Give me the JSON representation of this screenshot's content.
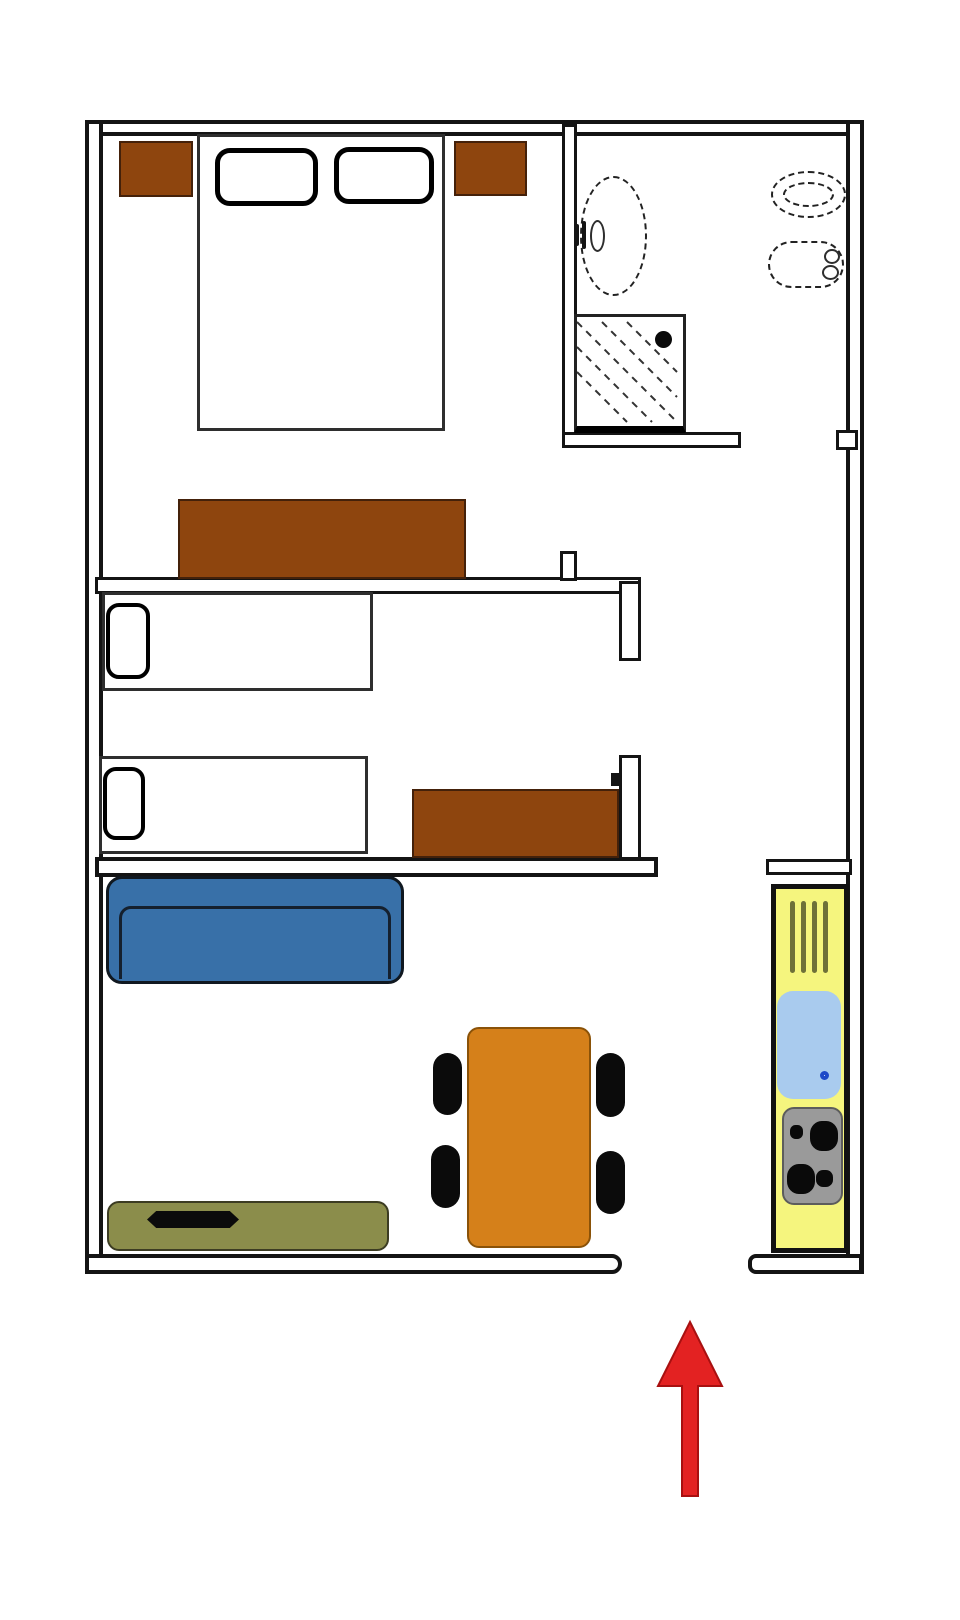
{
  "page": {
    "type": "apartment floor plan diagram",
    "orientation": "entrance at bottom, indicated by red arrow pointing up",
    "visible_text": "none"
  },
  "colors": {
    "background": "#ffffff",
    "wall_outline": "#141414",
    "wall_core": "#ffffff",
    "fixture_line": "#222222",
    "furniture_brown": "#8E450E",
    "bed_white": "#ffffff",
    "sofa_blue": "#3870A8",
    "table_orange": "#D5801A",
    "chair_black": "#0b0b0b",
    "sideboard_olive": "#8B8D4B",
    "tv_black": "#0b0b0b",
    "kitchen_yellow": "#F5F57E",
    "sink_light_blue": "#A9CBEE",
    "drain_blue": "#1d49c8",
    "stove_gray": "#9A9A9A",
    "burner_black": "#0a0a0a",
    "radiator_olive": "#6E7038",
    "arrow_red": "#E32222",
    "arrow_red_dark": "#A81010"
  },
  "rooms": [
    {
      "id": "master-bedroom",
      "position": "top-left",
      "furniture": [
        "double bed with 2 pillows",
        "nightstand left",
        "nightstand right",
        "dresser at foot wall"
      ]
    },
    {
      "id": "bathroom",
      "position": "top-right",
      "fixtures": [
        "washbasin (dashed oval with taps)",
        "toilet (double dashed oval)",
        "bidet (dashed, two holes)",
        "shower tray (hatched, drain dot)"
      ]
    },
    {
      "id": "second-bedroom",
      "position": "middle-left",
      "furniture": [
        "single bed with pillow (upper)",
        "single bed with pillow (lower)",
        "dresser at right"
      ]
    },
    {
      "id": "hallway",
      "position": "center-right",
      "furniture": []
    },
    {
      "id": "living-room",
      "position": "bottom-left",
      "furniture": [
        "sofa (blue)",
        "sideboard with TV (olive)",
        "dining table (orange)",
        "4 chairs (black)"
      ]
    },
    {
      "id": "kitchen",
      "position": "right vertical strip",
      "fixtures": [
        "radiator (4 bars)",
        "sink with drain",
        "stove with 4 burners"
      ]
    }
  ],
  "openings": [
    {
      "id": "entrance",
      "location": "bottom wall gap, marked by red arrow"
    },
    {
      "id": "master-bedroom-door",
      "location": "right side of master bedroom, jamb tick on bottom wall"
    },
    {
      "id": "second-bedroom-door",
      "location": "gap in right wall of second bedroom"
    },
    {
      "id": "bathroom-door",
      "location": "gap in bathroom bottom wall near right outer wall"
    },
    {
      "id": "living-room-passage",
      "location": "gap between living room top wall and kitchen top wall"
    }
  ],
  "annotations": {
    "entrance_arrow": {
      "description": "red arrow pointing up toward entrance opening",
      "color": "#E32222"
    }
  }
}
